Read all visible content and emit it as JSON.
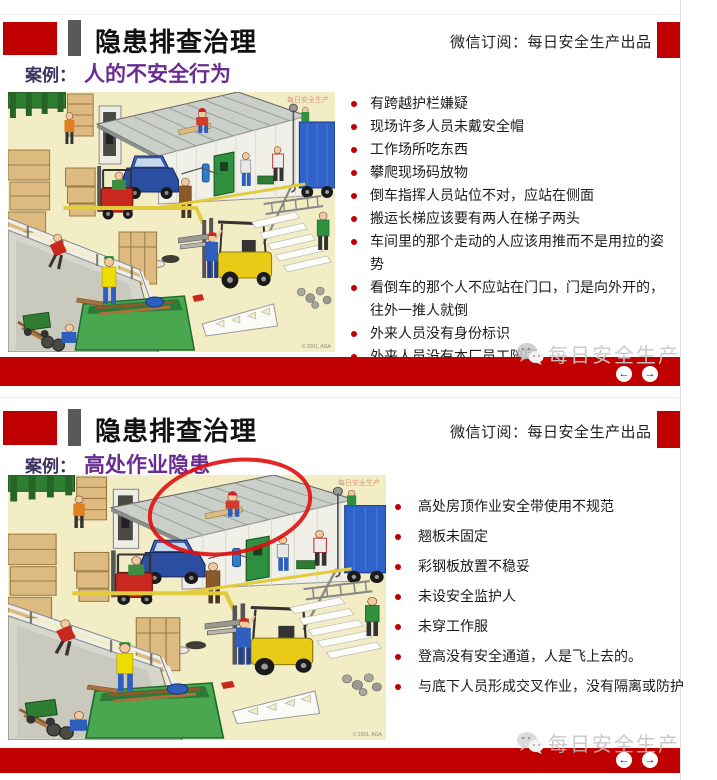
{
  "colors": {
    "accent_red": "#C00000",
    "bar_gray": "#595959",
    "subtitle_purple": "#6B2C91",
    "bullet_red": "#C00000"
  },
  "footer": {
    "watermark": "每日安全生产",
    "prev_icon": "←",
    "next_icon": "→"
  },
  "illustration": {
    "name": "warehouse-hazard-cartoon",
    "watermark": "每日安全生产",
    "credit": "© 2001, AGA"
  },
  "slides": [
    {
      "title": "隐患排查治理",
      "wechat_line": "微信订阅：每日安全生产出品",
      "case_label": "案例：",
      "case_value": "人的不安全行为",
      "bullets": [
        "有跨越护栏嫌疑",
        "现场许多人员未戴安全帽",
        "工作场所吃东西",
        "攀爬现场码放物",
        "倒车指挥人员站位不对，应站在侧面",
        "搬运长梯应该要有两人在梯子两头",
        "车间里的那个走动的人应该用推而不是用拉的姿势",
        "看倒车的那个人不应站在门口，门是向外开的，往外一推人就倒",
        "外来人员没有身份标识",
        "外来人员没有本厂员工陪同"
      ]
    },
    {
      "title": "隐患排查治理",
      "wechat_line": "微信订阅：每日安全生产出品",
      "case_label": "案例：",
      "case_value": "高处作业隐患",
      "bullets": [
        "高处房顶作业安全带使用不规范",
        "翘板未固定",
        "彩钢板放置不稳妥",
        "未设安全监护人",
        "未穿工作服",
        "登高没有安全通道，人是飞上去的。",
        "与底下人员形成交叉作业，没有隔离或防护"
      ]
    }
  ]
}
